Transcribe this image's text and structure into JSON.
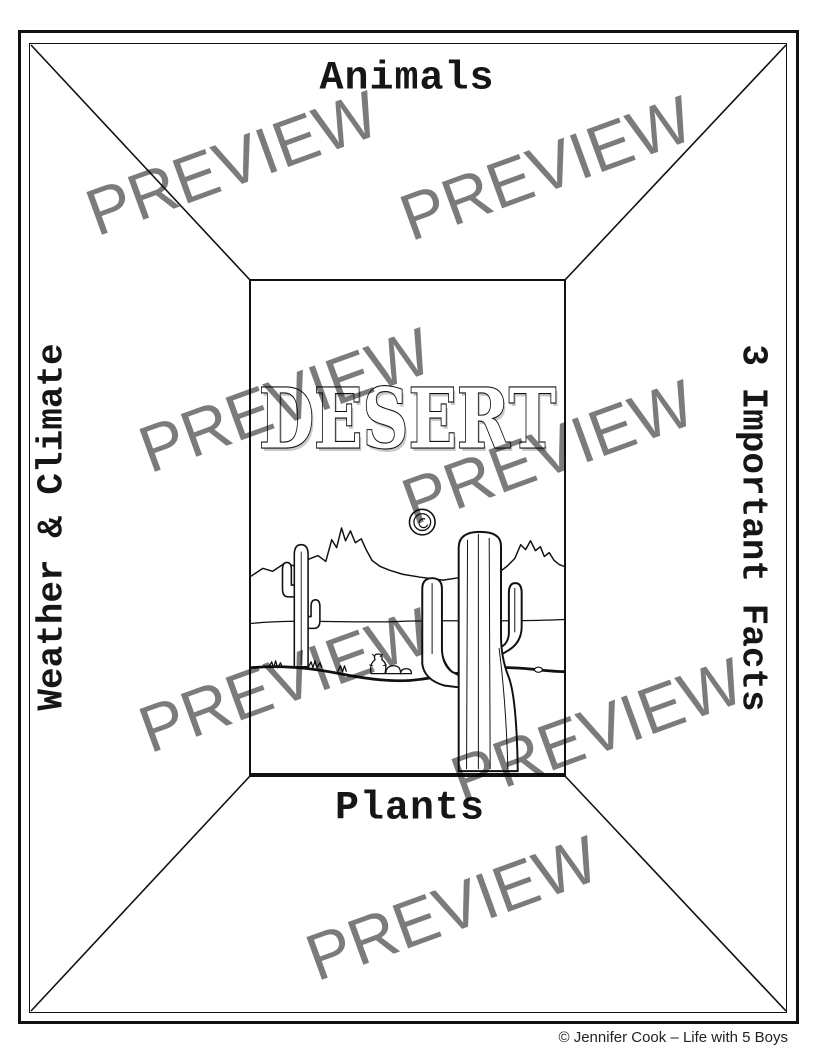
{
  "document": {
    "kind": "printable-worksheet-preview",
    "watermark": {
      "text": "PREVIEW",
      "color": "#7b7b7b"
    },
    "sections": {
      "top_label": "Animals",
      "left_label": "Weather & Climate",
      "right_label": "3 Important Facts",
      "bottom_label": "Plants"
    },
    "center_panel": {
      "title": "DESERT",
      "scene_elements": [
        "sun",
        "mountains",
        "small saguaro cactus",
        "large saguaro cactus",
        "prickly pear cactus",
        "rocks",
        "grass tufts",
        "desert ground"
      ]
    },
    "footer": {
      "copyright": "© Jennifer Cook – Life with 5 Boys"
    },
    "colors": {
      "ink": "#111111",
      "background": "#ffffff",
      "watermark": "#7b7b7b",
      "title_shadow": "#c9c9c9"
    }
  }
}
